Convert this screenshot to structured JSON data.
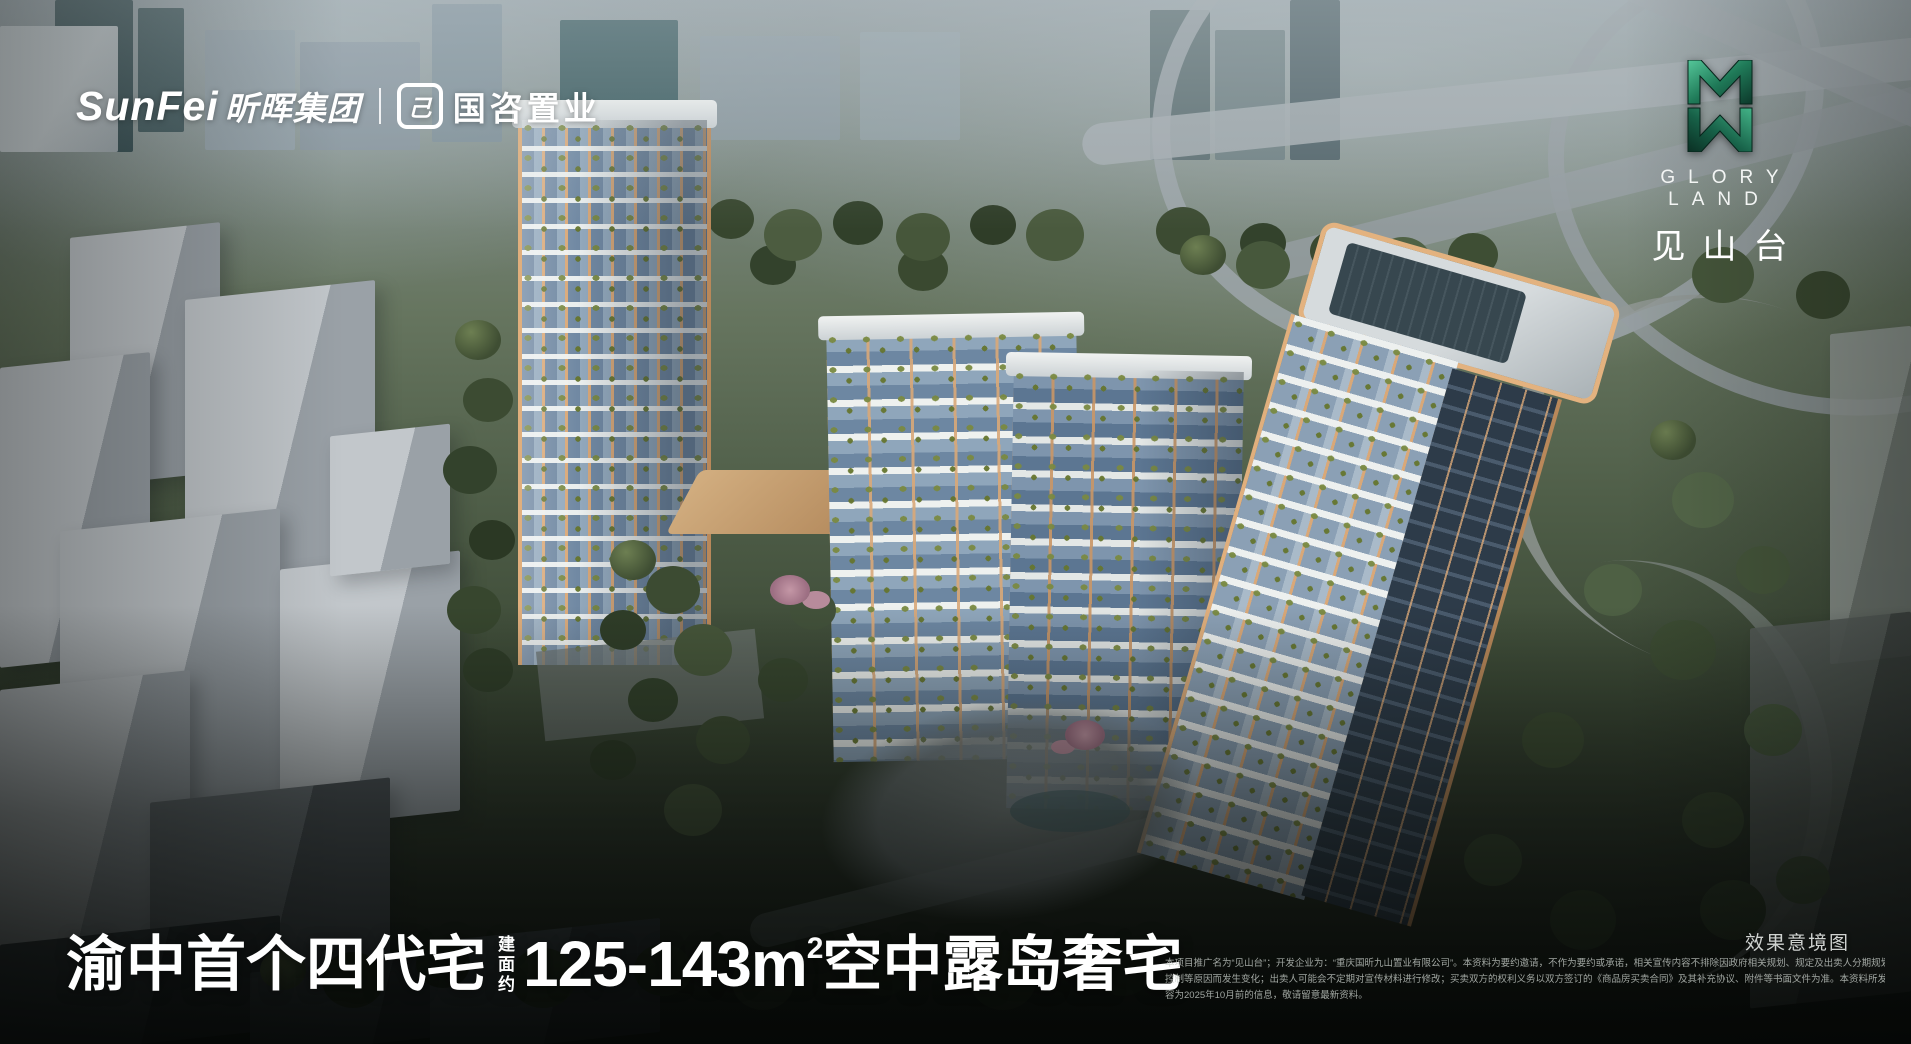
{
  "brand": {
    "latin": "SunFei",
    "cn": "昕晖集团",
    "partner": "国咨置业",
    "partner_icon": "己"
  },
  "project_logo": {
    "name_en": "G L O R Y L A N D",
    "name_en_display": "GLORY LAND",
    "name_cn": "见山台"
  },
  "headline": {
    "part1": "渝中首个四代宅",
    "area_chars": [
      "建",
      "面",
      "约"
    ],
    "size_range": "125-143m",
    "sup": "2",
    "part2": "空中露岛奢宅"
  },
  "watermark": "效果意境图",
  "disclaimer": {
    "lines": [
      "本项目推广名为“见山台”；开发企业为：“重庆国昕九山置业有限公司”。本资料为要约邀请，不作为要约或承诺，相关宣传内容不排除因政府相关规划、规定及出卖人分期规划、未能",
      "控制等原因而发生变化；出卖人可能会不定期对宣传材料进行修改；买卖双方的权利义务以双方签订的《商品房买卖合同》及其补充协议、附件等书面文件为准。本资料所发布的内",
      "容为2025年10月前的信息，敬请留意最新资料。"
    ]
  },
  "colors": {
    "logo_green_light": "#55c79a",
    "logo_green_mid": "#1f7a58",
    "logo_green_dark": "#0c382a",
    "accent_orange": "#d9a878",
    "text_white": "#ffffff"
  }
}
